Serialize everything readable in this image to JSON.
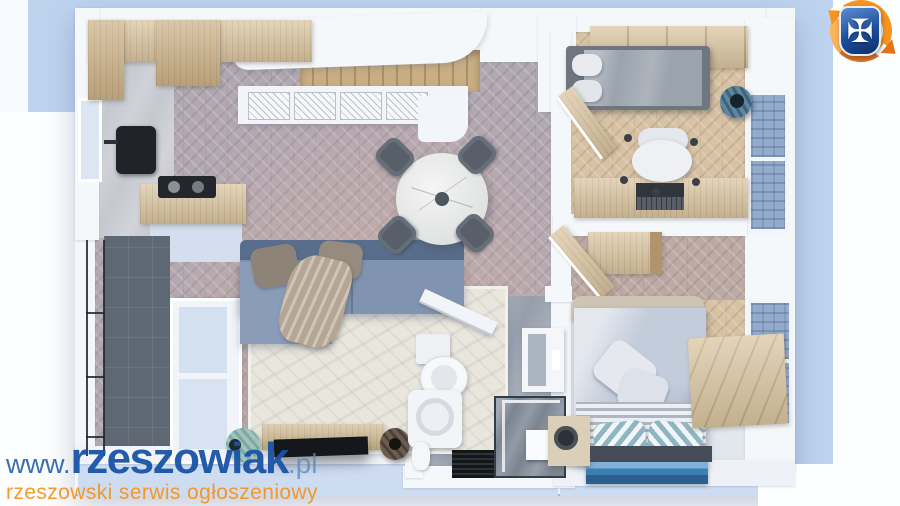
{
  "watermark": {
    "url_prefix": "www.",
    "url_main": "rzeszowiak",
    "url_suffix": ".pl",
    "tagline": "rzeszowski serwis ogłoszeniowy",
    "blue": "#1d57a9",
    "orange": "#f7941e"
  },
  "logo": {
    "name": "rzeszowiak-shield-logo",
    "cross_glyph": "✠",
    "shield_blue": "#1c4e9c",
    "ring_orange": "#f58220"
  },
  "palette": {
    "canvas_blue": "#bdd3ee",
    "wall_white": "#f4f7fb",
    "living_floor": "#b2a8b2",
    "living_floor_warm": "#d4b3a4",
    "bedroom_floor": "#d8c2a3",
    "corridor_floor": "#bdaaa4",
    "bathroom_floor": "#959eac",
    "balcony_tile": "#5d6874",
    "wood": "#d9c49f",
    "sofa_blue": "#7d92b0",
    "bed_blue": "#c2cbd9",
    "rug_cream": "#e9e6de"
  },
  "scene": {
    "description": "3D top-down render of an apartment floor plan",
    "rooms": [
      "kitchen",
      "living-room",
      "dining-area",
      "balcony",
      "staircase",
      "bedroom-office",
      "hallway",
      "bathroom",
      "bedroom"
    ]
  }
}
